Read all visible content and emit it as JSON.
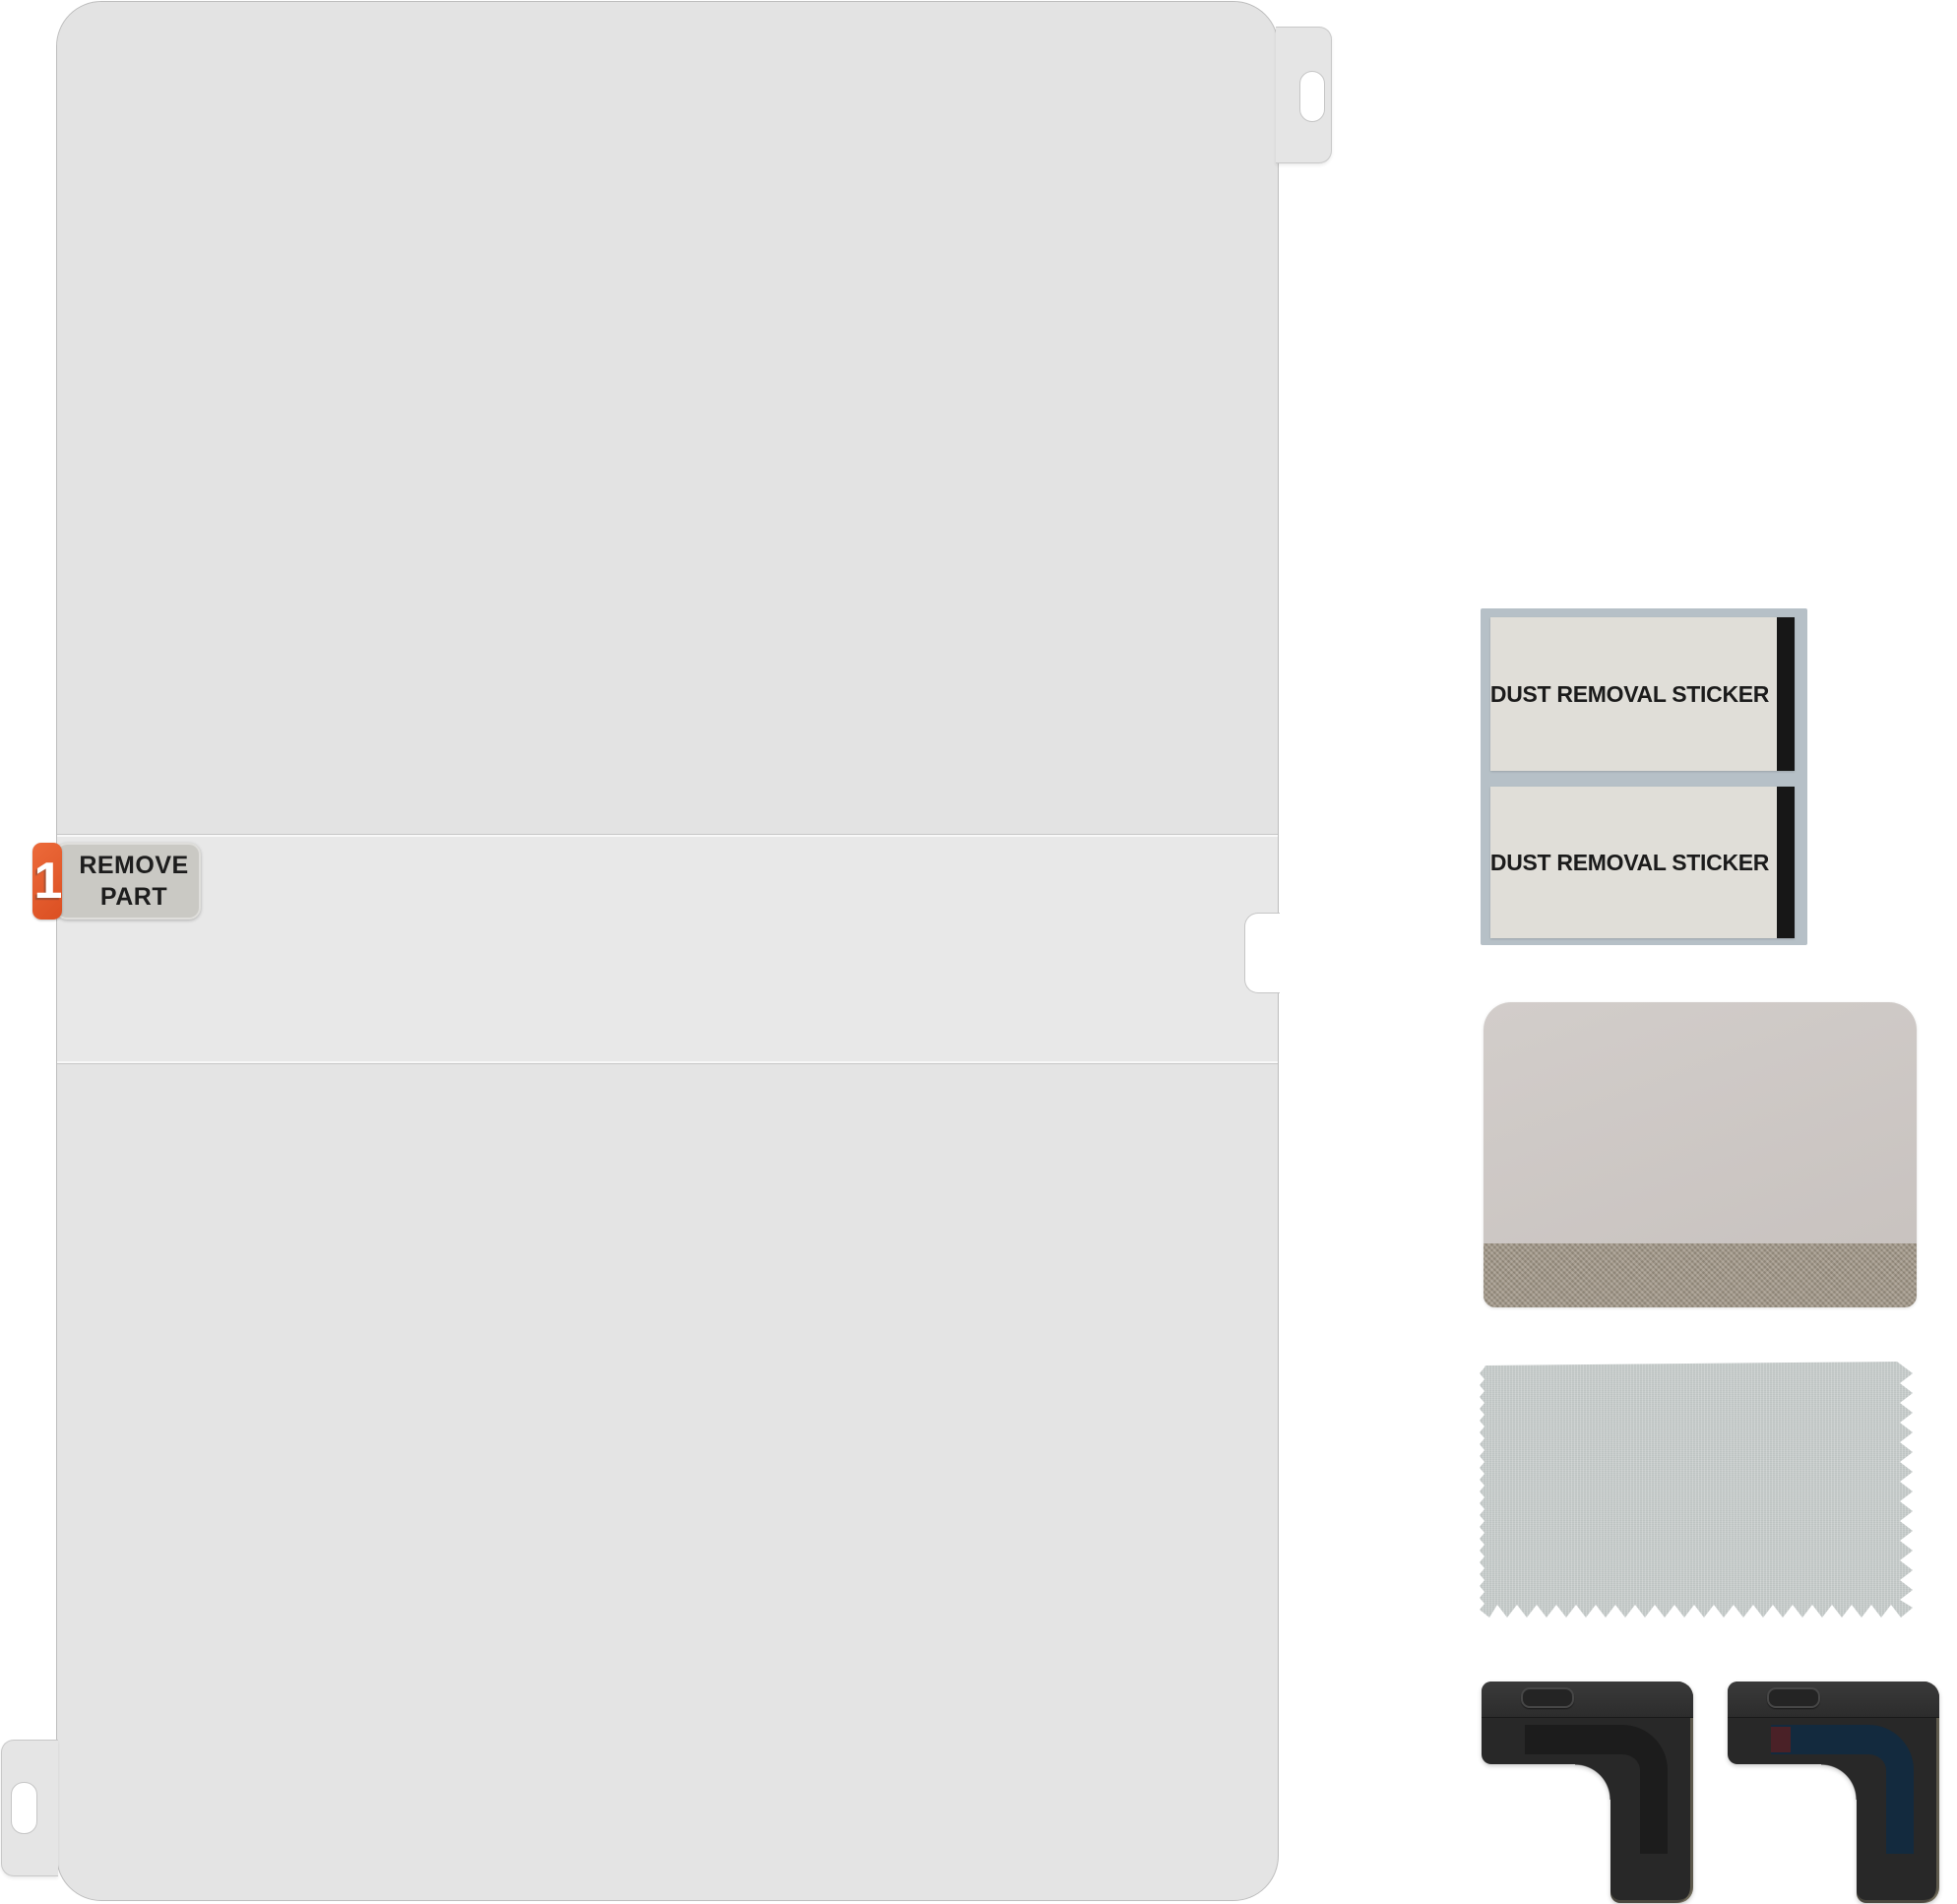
{
  "film": {
    "step_number": "1",
    "remove_line1": "REMOVE",
    "remove_line2": "PART",
    "accent_color": "#e2562c"
  },
  "accessories": {
    "dust_stickers": [
      {
        "label": "DUST REMOVAL STICKER"
      },
      {
        "label": "DUST REMOVAL STICKER"
      }
    ]
  },
  "colors": {
    "film": "#e4e4e4",
    "film_remove_strip": "#e8e8e8",
    "sticker_backing": "#b6c0c7",
    "sticker_face": "#e0ded8",
    "sticker_stripe": "#171717",
    "squeegee": "#cdc8c5",
    "squeegee_felt": "#998f82",
    "cloth": "#c6cbca",
    "guide_body": "#282828",
    "guide_inner_blue": "#132a3e",
    "guide_chip_red": "#4a2127"
  }
}
